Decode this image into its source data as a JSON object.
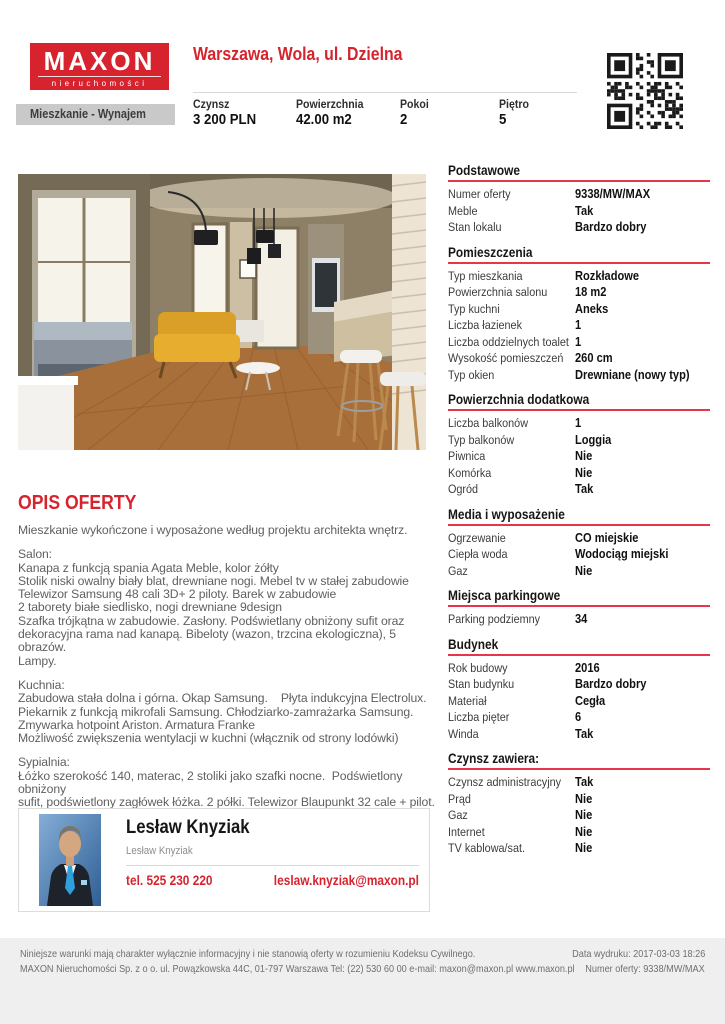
{
  "brand": {
    "logo_title": "MAXON",
    "logo_subtitle": "nieruchomości"
  },
  "header": {
    "title": "Warszawa, Wola, ul. Dzielna",
    "category": "Mieszkanie - Wynajem",
    "stats": [
      {
        "label": "Czynsz",
        "value": "3 200 PLN"
      },
      {
        "label": "Powierzchnia",
        "value": "42.00 m2"
      },
      {
        "label": "Pokoi",
        "value": "2"
      },
      {
        "label": "Piętro",
        "value": "5"
      }
    ]
  },
  "offer": {
    "heading": "OPIS OFERTY",
    "paragraphs": [
      "Mieszkanie wykończone i wyposażone według projektu architekta wnętrz.",
      "Salon:\nKanapa z funkcją spania Agata Meble, kolor żółty\nStolik niski owalny biały blat, drewniane nogi. Mebel tv w stałej zabudowie\nTelewizor Samsung 48 cali 3D+ 2 piloty. Barek w zabudowie\n2 taborety białe siedlisko, nogi drewniane 9design\nSzafka trójkątna w zabudowie. Zasłony. Podświetlany obniżony sufit oraz\ndekoracyjna rama nad kanapą. Bibeloty (wazon, trzcina ekologiczna), 5 obrazów.\nLampy.",
      "Kuchnia:\nZabudowa stała dolna i górna. Okap Samsung.    Płyta indukcyjna Electrolux.\nPiekarnik z funkcją mikrofali Samsung. Chłodziarko-zamrażarka Samsung.\nZmywarka hotpoint Ariston. Armatura Franke\nMożliwość zwiększenia wentylacji w kuchni (włącznik od strony lodówki)",
      "Sypialnia:\nŁóżko szerokość 140, materac, 2 stoliki jako szafki nocne.  Podświetlony obniżony\nsufit, podświetlony zagłówek łóżka. 2 półki. Telewizor Blaupunkt 32 cale + pilot.\nzasłony i 3 poduszki. 2 obrazy, bibelot (niebieski słoń)"
    ]
  },
  "details": {
    "sections": [
      {
        "title": "Podstawowe",
        "rows": [
          {
            "label": "Numer oferty",
            "value": "9338/MW/MAX"
          },
          {
            "label": "Meble",
            "value": "Tak"
          },
          {
            "label": "Stan lokalu",
            "value": "Bardzo dobry"
          }
        ]
      },
      {
        "title": "Pomieszczenia",
        "rows": [
          {
            "label": "Typ mieszkania",
            "value": "Rozkładowe"
          },
          {
            "label": "Powierzchnia salonu",
            "value": "18 m2"
          },
          {
            "label": "Typ kuchni",
            "value": "Aneks"
          },
          {
            "label": "Liczba łazienek",
            "value": "1"
          },
          {
            "label": "Liczba oddzielnych toalet",
            "value": "1"
          },
          {
            "label": "Wysokość pomieszczeń",
            "value": "260 cm"
          },
          {
            "label": "Typ okien",
            "value": "Drewniane (nowy typ)"
          }
        ]
      },
      {
        "title": "Powierzchnia dodatkowa",
        "rows": [
          {
            "label": "Liczba balkonów",
            "value": "1"
          },
          {
            "label": "Typ balkonów",
            "value": "Loggia"
          },
          {
            "label": "Piwnica",
            "value": "Nie"
          },
          {
            "label": "Komórka",
            "value": "Nie"
          },
          {
            "label": "Ogród",
            "value": "Tak"
          }
        ]
      },
      {
        "title": "Media i wyposażenie",
        "rows": [
          {
            "label": "Ogrzewanie",
            "value": "CO miejskie"
          },
          {
            "label": "Ciepła woda",
            "value": "Wodociąg miejski"
          },
          {
            "label": "Gaz",
            "value": "Nie"
          }
        ]
      },
      {
        "title": "Miejsca parkingowe",
        "rows": [
          {
            "label": "Parking podziemny",
            "value": "34"
          }
        ]
      },
      {
        "title": "Budynek",
        "rows": [
          {
            "label": "Rok budowy",
            "value": "2016"
          },
          {
            "label": "Stan budynku",
            "value": "Bardzo dobry"
          },
          {
            "label": "Materiał",
            "value": "Cegła"
          },
          {
            "label": "Liczba pięter",
            "value": "6"
          },
          {
            "label": "Winda",
            "value": "Tak"
          }
        ]
      },
      {
        "title": "Czynsz zawiera:",
        "rows": [
          {
            "label": "Czynsz administracyjny",
            "value": "Tak"
          },
          {
            "label": "Prąd",
            "value": "Nie"
          },
          {
            "label": "Gaz",
            "value": "Nie"
          },
          {
            "label": "Internet",
            "value": "Nie"
          },
          {
            "label": "TV kablowa/sat.",
            "value": "Nie"
          }
        ]
      }
    ]
  },
  "agent": {
    "name": "Lesław Knyziak",
    "subtitle": "Lesław Knyziak",
    "phone": "tel. 525 230 220",
    "email": "leslaw.knyziak@maxon.pl"
  },
  "footer": {
    "disclaimer": "Niniejsze warunki mają charakter wyłącznie informacyjny i nie stanowią oferty w rozumieniu Kodeksu Cywilnego.",
    "company": "MAXON Nieruchomości Sp. z o o. ul. Powązkowska 44C, 01-797 Warszawa Tel: (22) 530 60 00 e-mail: maxon@maxon.pl www.maxon.pl",
    "print_date": "Data wydruku: 2017-03-03 18:26",
    "offer_number": "Numer oferty: 9338/MW/MAX"
  },
  "colors": {
    "brand_red": "#d6232e",
    "underline_red": "#e4374a",
    "footer_bg": "#efefef"
  }
}
